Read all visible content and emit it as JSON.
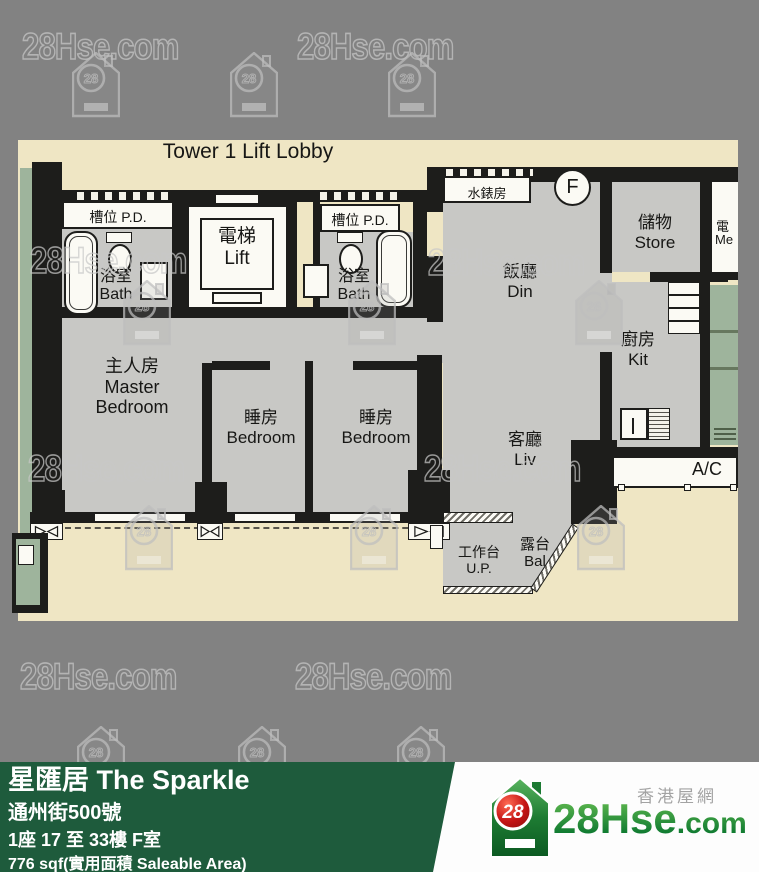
{
  "watermark": {
    "text": "28Hse.com",
    "icon_number": "28"
  },
  "plan": {
    "title": "Tower 1 Lift Lobby",
    "rooms": {
      "pd1": "槽位 P.D.",
      "pd2": "槽位 P.D.",
      "lift_zh": "電梯",
      "lift_en": "Lift",
      "bath1_zh": "浴室",
      "bath1_en": "Bath",
      "bath2_zh": "浴室",
      "bath2_en": "Bath",
      "water_meter": "水錶房",
      "unit_letter": "F",
      "store_zh": "儲物",
      "store_en": "Store",
      "din_zh": "飯廳",
      "din_en": "Din",
      "kit_zh": "廚房",
      "kit_en": "Kit",
      "master_zh": "主人房",
      "master_en1": "Master",
      "master_en2": "Bedroom",
      "bed1_zh": "睡房",
      "bed1_en": "Bedroom",
      "bed2_zh": "睡房",
      "bed2_en": "Bedroom",
      "liv_zh": "客廳",
      "liv_en": "Liv",
      "ac": "A/C",
      "up_zh": "工作台",
      "up_en": "U.P.",
      "bal_zh": "露台",
      "bal_en": "Bal",
      "meter_zh": "電",
      "meter_en": "Me"
    }
  },
  "footer": {
    "estate_name": "星匯居 The Sparkle",
    "address": "通州街500號",
    "unit": "1座 17 至 33樓 F室",
    "area": "776 sqf(實用面積 Saleable Area)"
  },
  "logo": {
    "site_zh": "香港屋網",
    "brand_main": "28Hse",
    "brand_suffix": ".com",
    "badge": "28"
  },
  "colors": {
    "background_gray": "#828282",
    "plan_paper": "#efe6c4",
    "room_fill": "#c8c8c5",
    "green_feature": "#9eb49c",
    "bar_green": "#1e5b3c",
    "brand_green": "#1d8b3a",
    "badge_red": "#cf1d15"
  }
}
